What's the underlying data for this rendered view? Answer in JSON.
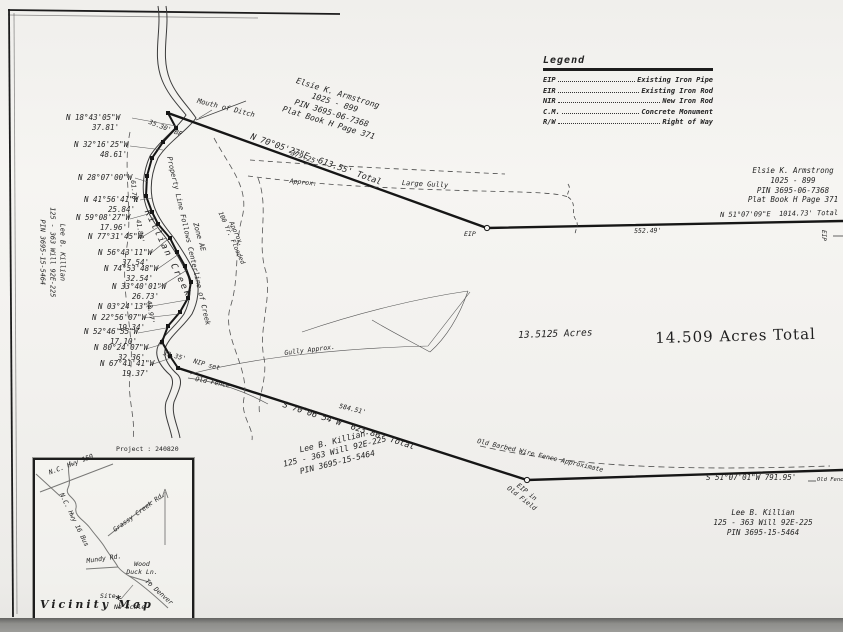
{
  "project_label": "Project : 240820",
  "legend": {
    "title": "Legend",
    "items": [
      {
        "abbr": "EIP",
        "desc": "Existing Iron Pipe"
      },
      {
        "abbr": "EIR",
        "desc": "Existing Iron Rod"
      },
      {
        "abbr": "NIR",
        "desc": "New Iron Rod"
      },
      {
        "abbr": "C.M.",
        "desc": "Concrete Monument"
      },
      {
        "abbr": "R/W",
        "desc": "Right of Way"
      }
    ]
  },
  "owners": {
    "armstrong_top": {
      "line1": "Elsie K. Armstrong",
      "line2": "1025 - 899",
      "line3": "PIN 3695-06-7368",
      "line4": "Plat Book H Page 371"
    },
    "armstrong_right": {
      "line1": "Elsie K. Armstrong",
      "line2": "1025 - 899",
      "line3": "PIN 3695-06-7368",
      "line4": "Plat Book H Page 371"
    },
    "killian_center": {
      "line1": "Lee B. Killian",
      "line2": "125 - 363 Will 92E-225",
      "line3": "PIN 3695-15-5464"
    },
    "killian_right": {
      "line1": "Lee B. Killian",
      "line2": "125 - 363 Will 92E-225",
      "line3": "PIN 3695-15-5464"
    },
    "killian_left": {
      "line1": "Lee B. Killian",
      "line2": "125 - 363 Will 92E-225",
      "line3": "PIN 3695-15-5464"
    }
  },
  "areas": {
    "parcel": "13.5125 Acres",
    "total": "14.509 Acres Total"
  },
  "boundaries": {
    "top_bearing": "N 70°05'27\"E  613.55' Total",
    "top_partial": "379.25'",
    "right_bearing": "N 51°07'09\"E  1014.73' Total",
    "right_partial": "552.49'",
    "bottom_bearing": "S 70°06'54\"W  623.86' Total",
    "bottom_partial": "584.51'",
    "bottom_right_bearing": "S 51°07'01\"W 791.95'"
  },
  "creek_calls": [
    {
      "bearing": "N 18°43'05\"W",
      "distance": "37.81'"
    },
    {
      "bearing": "N 32°16'25\"W",
      "distance": "48.61'"
    },
    {
      "bearing": "N 28°07'00\"W",
      "distance": ""
    },
    {
      "bearing": "N 41°56'41\"W",
      "distance": "25.84'"
    },
    {
      "bearing": "N 59°08'27\"W",
      "distance": "17.96'"
    },
    {
      "bearing": "N 77°31'45\"W",
      "distance": ""
    },
    {
      "bearing": "N 56°43'11\"W",
      "distance": "37.54'"
    },
    {
      "bearing": "N 74°53'48\"W",
      "distance": "32.54'"
    },
    {
      "bearing": "N 33°40'01\"W",
      "distance": "26.73'"
    },
    {
      "bearing": "N 03°24'13\"E",
      "distance": ""
    },
    {
      "bearing": "N 22°56'07\"W",
      "distance": "19.34'"
    },
    {
      "bearing": "N 52°46'55\"W",
      "distance": "17.10'"
    },
    {
      "bearing": "N 80°24'07\"W",
      "distance": "32.36'"
    },
    {
      "bearing": "N 67°41'41\"W",
      "distance": "19.37'"
    }
  ],
  "notes": {
    "mouth_of_ditch": "Mouth of Ditch",
    "bf": "35.30' BF",
    "creek_seg1": "61.70'",
    "creek_seg2": "41.80'",
    "creek_seg3": "43.97'",
    "killian_creek": "Killian Creek",
    "property_line": "Property Line Follows Centerline of Creek",
    "zone": "Zone AE",
    "flood1": "100 Yr. Flooded",
    "flood2": "Approx.",
    "approx": "Approx.",
    "large_gully": "Large Gully",
    "gully_approx": "Gully Approx.",
    "nip": "39.35'  NIP set",
    "old_fence_creek": "Old Fence",
    "barbed": "Old Barbed Wire Fence Approximate",
    "eip_top": "EIP",
    "eip_right": "EIP",
    "eip_corner1": "EIP in",
    "eip_corner2": "Old Field",
    "old_fence_right": "Old Fence"
  },
  "vicinity": {
    "title": "Vicinity Map",
    "scale": "No Scale",
    "site": "Site",
    "star": "*",
    "roads": {
      "hwy150": "N.C. Hwy 150",
      "hwy16": "N.C. Hwy 16 Bus",
      "grassy": "Grassy Creek Rd.",
      "mundy": "Mundy Rd.",
      "wood1": "Wood",
      "wood2": "Duck Ln.",
      "denver": "To Denver"
    }
  }
}
